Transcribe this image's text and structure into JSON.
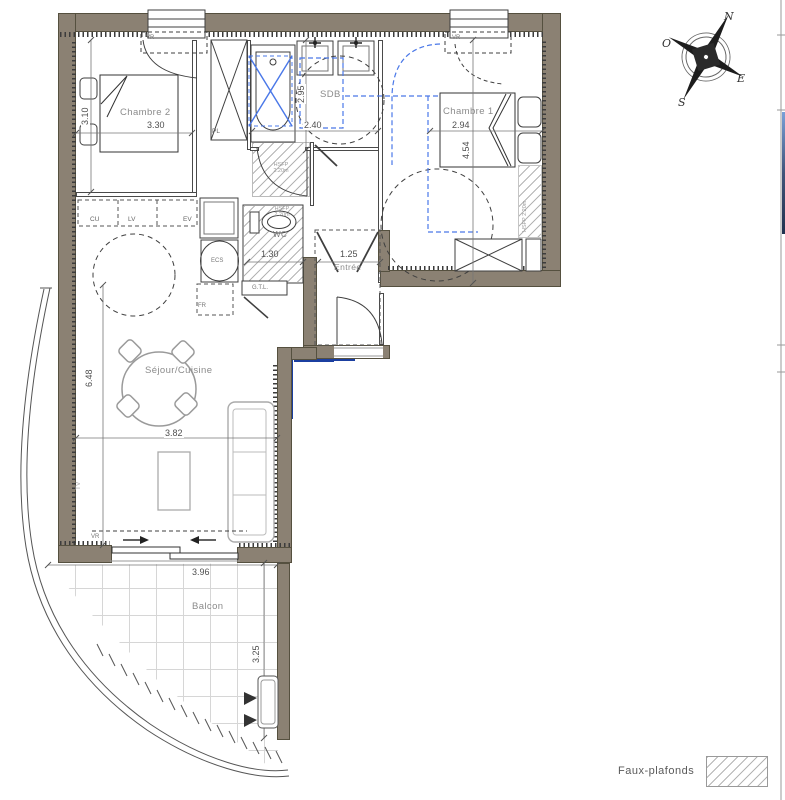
{
  "rooms": {
    "chambre2": {
      "label": "Chambre 2",
      "dim_w": "3.30",
      "dim_h": "3.10"
    },
    "chambre1": {
      "label": "Chambre 1",
      "dim_w": "2.94",
      "dim_h": "4.54"
    },
    "sdb": {
      "label": "SDB",
      "dim_w": "2.40",
      "dim_h": "2.95"
    },
    "sejour": {
      "label": "Séjour/Cuisine",
      "dim_w": "3.82",
      "dim_h": "6.48"
    },
    "entree": {
      "label": "Entrée",
      "dim_w": "1.25"
    },
    "wc": {
      "label": "WC",
      "dim_w": "1.30"
    },
    "balcon": {
      "label": "Balcon",
      "dim_w": "3.96",
      "dim_h": "3.25"
    }
  },
  "equipment": {
    "pl": "PL",
    "vr": "VR",
    "cu": "CU",
    "lv": "LV",
    "ev": "EV",
    "ecs": "ECS",
    "fr": "FR",
    "gtl": "G.T.L.",
    "tv": "TV"
  },
  "notes": {
    "hsfp_line1": "HSFP",
    "hsfp_line2": "2.20m",
    "hsfp_full": "HSFP 2.20m"
  },
  "legend": {
    "faux_plafonds": "Faux-plafonds"
  },
  "compass": {
    "n": "N",
    "e": "E",
    "s": "S",
    "o": "O"
  },
  "colors": {
    "wall": "#8b8173",
    "accessibility_blue": "#4a78e8",
    "navy": "#1b3fa0",
    "hatch_gray": "#b4b4b4"
  }
}
